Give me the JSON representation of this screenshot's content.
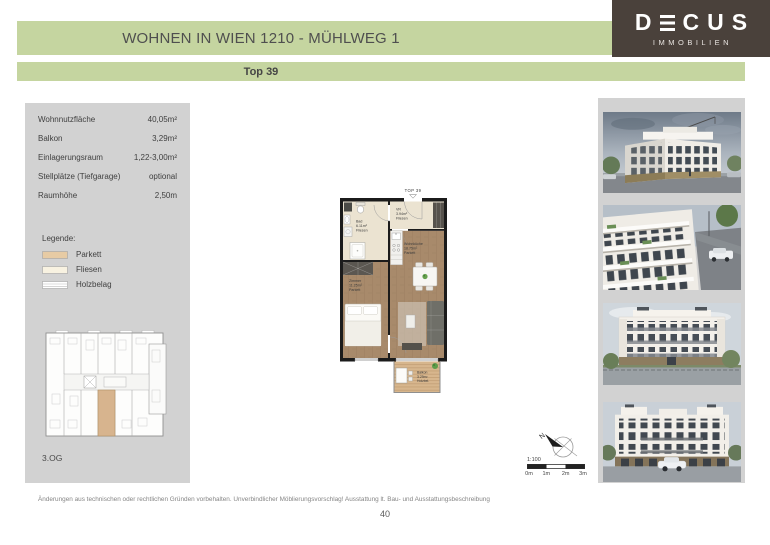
{
  "header": {
    "title": "WOHNEN IN WIEN 1210 - MÜHLWEG 1",
    "subtitle": "Top 39",
    "logo": {
      "brand": "DECUS",
      "tagline": "IMMOBILIEN"
    }
  },
  "info": {
    "rows": [
      {
        "label": "Wohnnutzfläche",
        "value": "40,05m²"
      },
      {
        "label": "Balkon",
        "value": "3,29m²"
      },
      {
        "label": "Einlagerungsraum",
        "value": "1,22-3,00m²"
      },
      {
        "label": "Stellplätze (Tiefgarage)",
        "value": "optional"
      },
      {
        "label": "Raumhöhe",
        "value": "2,50m"
      }
    ],
    "legend": {
      "title": "Legende:",
      "items": [
        {
          "label": "Parkett"
        },
        {
          "label": "Fliesen"
        },
        {
          "label": "Holzbelag"
        }
      ]
    },
    "floor_label": "3.OG"
  },
  "floorplan": {
    "unit_label": "TOP 39",
    "rooms": [
      {
        "name": "Bad",
        "area": "6.11m²",
        "floor": "Fliesen"
      },
      {
        "name": "VR",
        "area": "3.94m²",
        "floor": "Fliesen"
      },
      {
        "name": "Wohnküche",
        "area": "18.75m²",
        "floor": "Parkett"
      },
      {
        "name": "Zimmer",
        "area": "11.25m²",
        "floor": "Parkett"
      },
      {
        "name": "Balkon",
        "area": "3.29m²",
        "floor": "Holzbel."
      }
    ],
    "compass": {
      "north_label": "N"
    },
    "scale": {
      "ratio": "1:100",
      "ticks": [
        "0m",
        "1m",
        "2m",
        "3m"
      ]
    }
  },
  "gallery": {
    "images": [
      "exterior-corner-view",
      "balcony-closeup",
      "garden-elevation",
      "street-elevation"
    ]
  },
  "footer": {
    "disclaimer": "Änderungen aus technischen oder rechtlichen Gründen vorbehalten. Unverbindlicher Möblierungsvorschlag! Ausstattung lt. Bau- und Ausstattungsbeschreibung",
    "page": "40"
  },
  "colors": {
    "accent_green": "#c5d5a0",
    "logo_brown": "#4a413b",
    "panel_gray": "#d2d2d2",
    "legend_parkett": "#e7cba4",
    "legend_fliesen": "#f8f2e1",
    "plan_parkett": "#a88a6b",
    "plan_fliesen": "#ebe3d1",
    "balcony_wood": "#d7b68d",
    "wall": "#1b1b1b"
  }
}
